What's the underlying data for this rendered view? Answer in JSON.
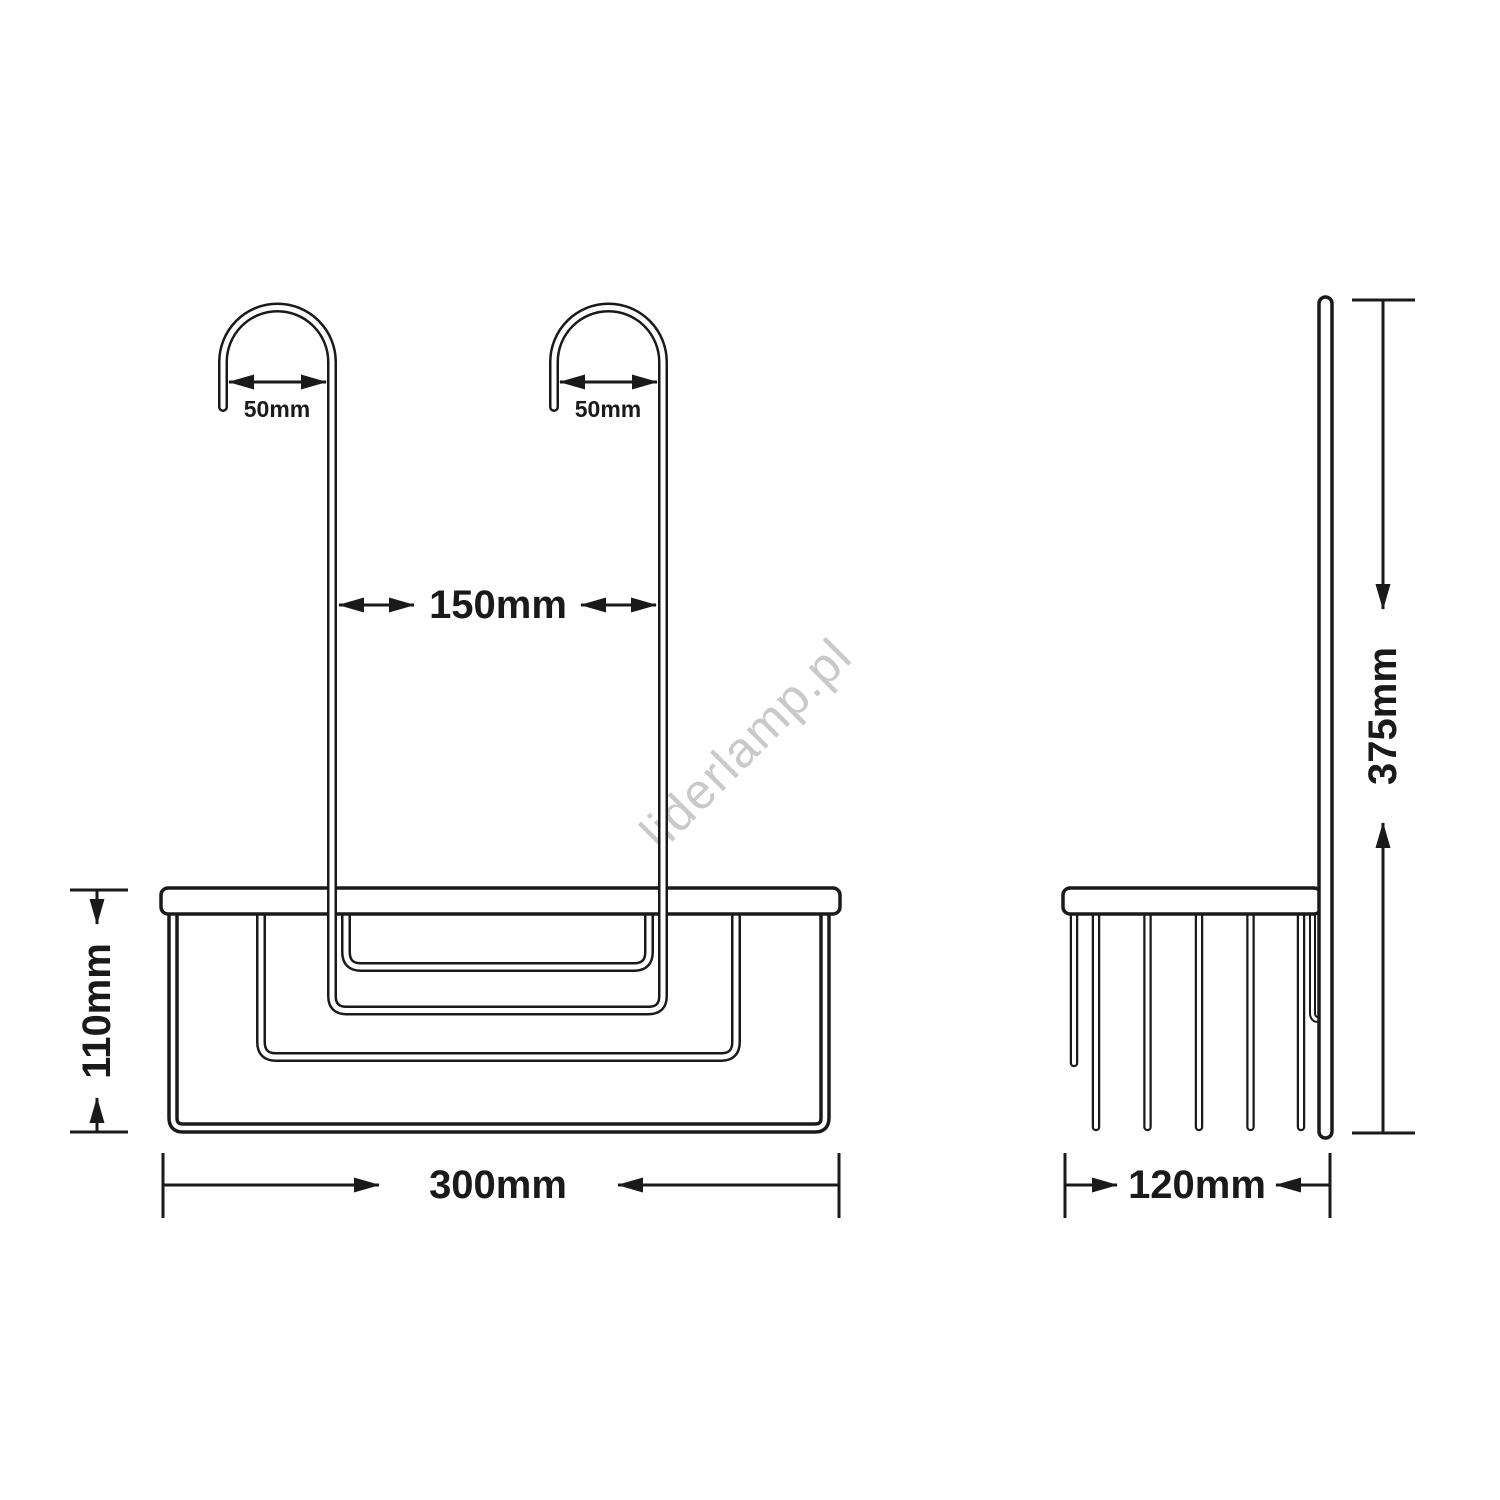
{
  "colors": {
    "line": "#1a1a1a",
    "background": "#ffffff",
    "watermark": "#c9c9c9"
  },
  "watermark": {
    "text": "liderlamp.pl"
  },
  "front_view": {
    "hook_left_width_label": "50mm",
    "hook_right_width_label": "50mm",
    "hook_spacing_label": "150mm",
    "height_label": "110mm",
    "width_label": "300mm"
  },
  "side_view": {
    "height_label": "375mm",
    "depth_label": "120mm"
  }
}
